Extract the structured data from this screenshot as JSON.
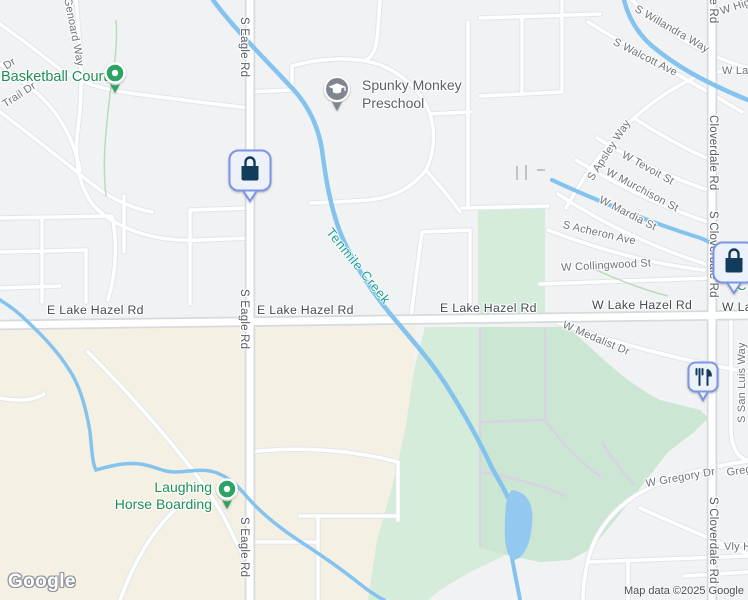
{
  "map": {
    "watermark": "Google",
    "attribution": "Map data ©2025 Google",
    "colors": {
      "land": "#f1f2f4",
      "residential": "#f5f0e4",
      "park": "#d4ecd9",
      "park_dark": "#cbe6d2",
      "water": "#85c3ef",
      "road_fill": "#ffffff",
      "road_casing": "#d6dade",
      "poi_green": "#1d8f55",
      "water_label": "#18a092",
      "pin_fill": "#edf1fc",
      "pin_border": "#7d96e3",
      "pin_glyph": "#113c5a",
      "pin_green": "#2ba363",
      "pin_gray": "#7f868e"
    },
    "pois": [
      {
        "label": "Basketball Court"
      },
      {
        "label": "Spunky Monkey Preschool",
        "line1": "Spunky Monkey",
        "line2": "Preschool"
      },
      {
        "label": "Laughing Horse Boarding",
        "line1": "Laughing",
        "line2": "Horse Boarding"
      },
      {
        "label": "C"
      }
    ],
    "water_labels": [
      {
        "text": "Tenmile Creek"
      }
    ],
    "road_labels": [
      {
        "text": "Genoard Way"
      },
      {
        "text": "Dr"
      },
      {
        "text": "Trail Dr"
      },
      {
        "text": "S Eagle Rd"
      },
      {
        "text": "S Eagle Rd"
      },
      {
        "text": "S Eagle Rd"
      },
      {
        "text": "S Willandra Way"
      },
      {
        "text": "S Walcott Ave"
      },
      {
        "text": "W Hig"
      },
      {
        "text": "Cloverdale Rd"
      },
      {
        "text": "Cloverdale Rd"
      },
      {
        "text": "S Cloverdale Rd"
      },
      {
        "text": "S Cloverdale Rd"
      },
      {
        "text": "S Apsley Way"
      },
      {
        "text": "W Tevoit St"
      },
      {
        "text": "W Murchison St"
      },
      {
        "text": "W Mardia St"
      },
      {
        "text": "S Acheron Ave"
      },
      {
        "text": "W Collingwood St"
      },
      {
        "text": "W La"
      },
      {
        "text": "E Lake Hazel Rd"
      },
      {
        "text": "E Lake Hazel Rd"
      },
      {
        "text": "E Lake Hazel Rd"
      },
      {
        "text": "W Lake Hazel Rd"
      },
      {
        "text": "W La"
      },
      {
        "text": "W Medalist Dr"
      },
      {
        "text": "S San Luis Way"
      },
      {
        "text": "W Gregory Dr"
      },
      {
        "text": "Greg"
      },
      {
        "text": "Vly H"
      }
    ]
  }
}
